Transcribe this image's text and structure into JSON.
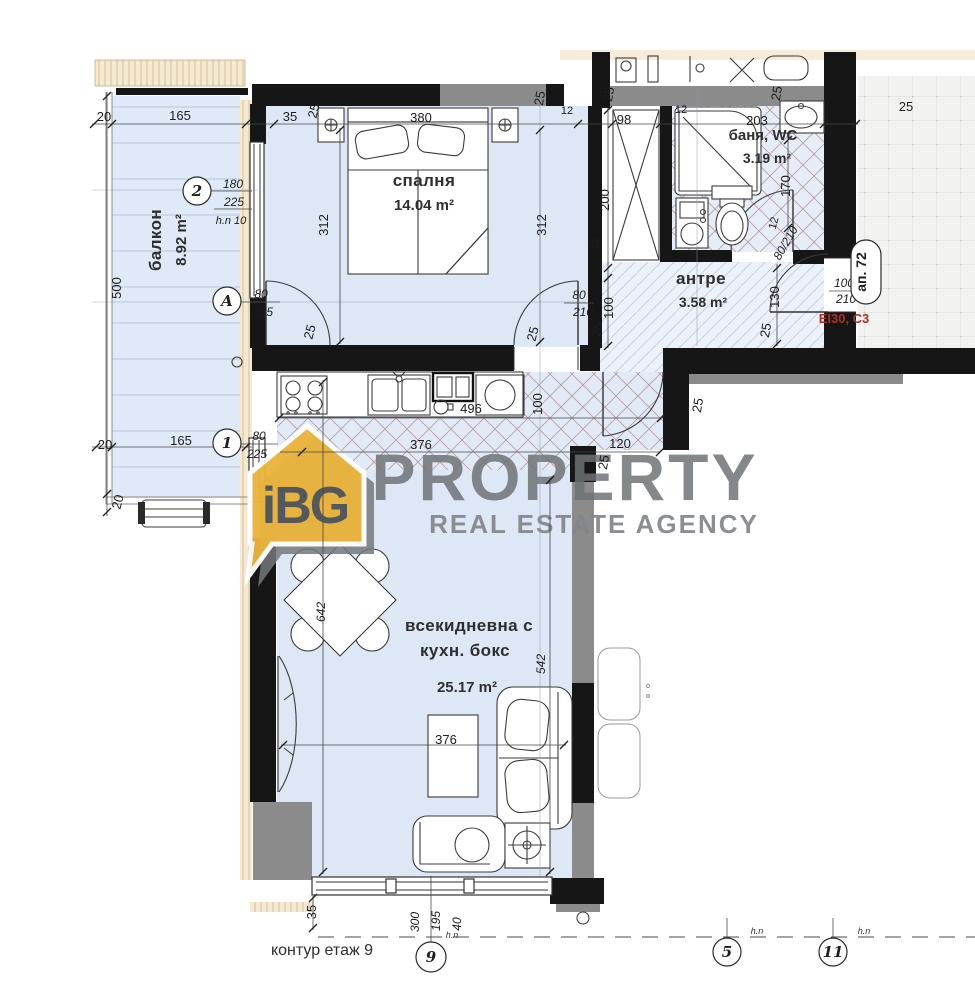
{
  "logo": {
    "badge": "iBG",
    "title": "PROPERTY",
    "subtitle": "REAL ESTATE AGENCY"
  },
  "rooms": {
    "balcony": {
      "name": "балкон",
      "area": "8.92 m²"
    },
    "bedroom": {
      "name": "спалня",
      "area": "14.04 m²"
    },
    "bathroom": {
      "name": "баня, WC",
      "area": "3.19 m²"
    },
    "hallway": {
      "name": "антре",
      "area": "3.58 m²"
    },
    "living": {
      "name_line1": "всекидневна с",
      "name_line2": "кухн. бокс",
      "area": "25.17 m²"
    }
  },
  "openings": {
    "win2": {
      "w": "180",
      "h": "225",
      "sill": "h.n 10"
    },
    "doorA": {
      "w": "80",
      "h": "235"
    },
    "door1": {
      "w": "80",
      "h": "225"
    },
    "bedroom_door": {
      "w": "80",
      "h": "210"
    },
    "bath_door": {
      "wh": "80/210"
    },
    "entry_door": {
      "w": "100",
      "h": "210"
    }
  },
  "grid_bubbles": {
    "b2": "2",
    "bA": "A",
    "b1": "1",
    "b9": "9",
    "b5": "5",
    "b11": "11"
  },
  "annotations": {
    "apartment_tag": "ап. 72",
    "fire_door_label": "EI30, C3",
    "floor_contour": "контур етаж 9",
    "level_mark": "h.n"
  },
  "dims": {
    "d20": "20",
    "d165": "165",
    "d35": "35",
    "d25": "25",
    "d380": "380",
    "d12": "12",
    "d98": "98",
    "d203": "203",
    "d500": "500",
    "d312": "312",
    "d200": "200",
    "d170": "170",
    "d130": "130",
    "d100": "100",
    "d496": "496",
    "d376": "376",
    "d120": "120",
    "d642": "642",
    "d542": "542",
    "d300": "300",
    "d195": "195",
    "d40": "40"
  },
  "colors": {
    "logo_gold": "#EAB43D",
    "logo_gray": "#6E7276",
    "fire_label_red": "#A93226",
    "room_fill": "#DDE7F6",
    "hatch_line": "#9C7D85"
  }
}
